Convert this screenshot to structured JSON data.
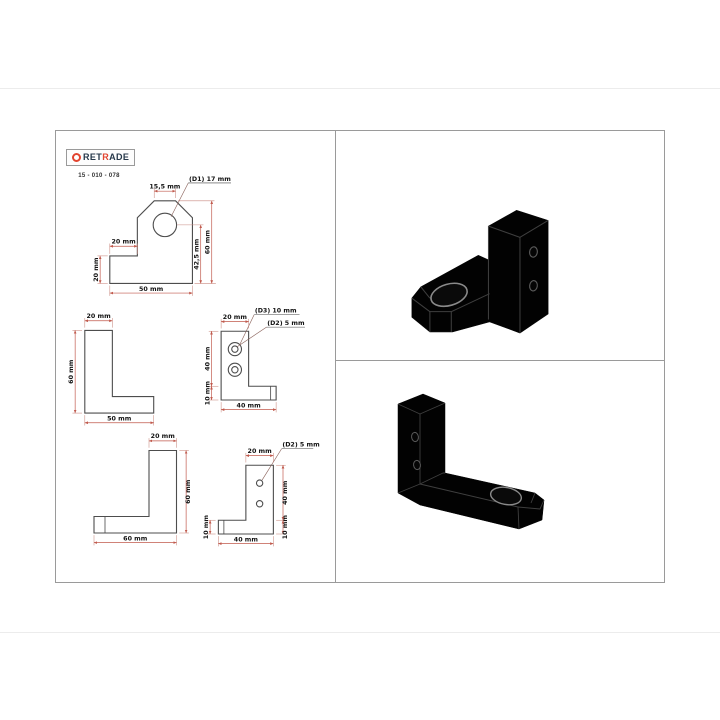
{
  "header": {
    "brand_pre": "RET",
    "brand_accent": "R",
    "brand_post": "ADE",
    "part_number": "15 - 010 - 078"
  },
  "views": {
    "front": {
      "hole_label": "(D1) 17 mm",
      "top_width": "15,5 mm",
      "step_width": "20 mm",
      "step_height": "20 mm",
      "hole_height": "42,5 mm",
      "overall_height": "60 mm",
      "overall_width": "50 mm"
    },
    "profile_left": {
      "top_width": "20 mm",
      "height": "60 mm",
      "length": "50 mm"
    },
    "holes_left": {
      "counterbore_label": "(D3) 10 mm",
      "hole_label": "(D2) 5 mm",
      "top_width": "20 mm",
      "column_height": "40 mm",
      "base_thickness": "10 mm",
      "width": "40 mm"
    },
    "profile_right": {
      "top_width": "20 mm",
      "height": "60 mm",
      "length": "60 mm"
    },
    "holes_right": {
      "hole_label": "(D2) 5 mm",
      "top_width": "20 mm",
      "column_height": "40 mm",
      "base_thickness_right": "10 mm",
      "base_thickness_left": "10 mm",
      "width": "40 mm"
    }
  },
  "colors": {
    "dimension_red": "#c0594c",
    "outline_gray": "#4d4d4d",
    "brand_navy": "#26384a",
    "brand_red": "#e2442f",
    "render_black": "#020202"
  },
  "renders": {
    "top": "isometric-render-rear",
    "bottom": "isometric-render-front"
  }
}
